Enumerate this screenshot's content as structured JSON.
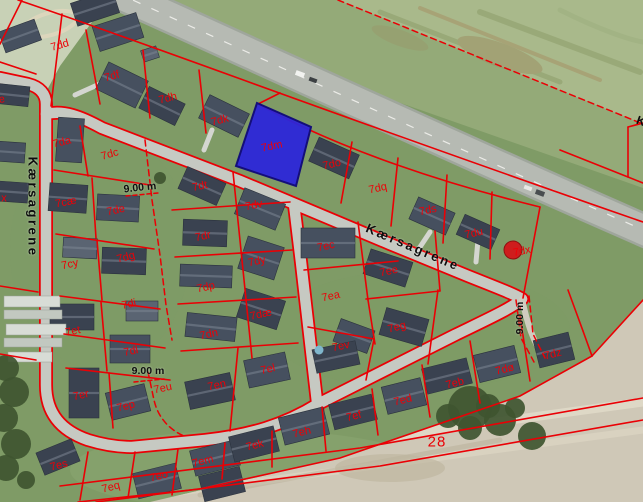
{
  "map": {
    "selected_parcel": {
      "label": "7dm",
      "fill_color": "#2c26d9",
      "border_color": "#140e7a"
    },
    "marker": {
      "type": "circle",
      "color": "#ce1d1d",
      "on_parcel": "7dx"
    },
    "colors": {
      "cadastral_line": "#ea0005",
      "parcel_label": "#ed0007",
      "street_label": "#0d0d0d",
      "highway": "#b6bab3",
      "grass": "#7f9b66",
      "field_dirt": "#cfc8b7"
    },
    "street_labels": [
      {
        "text": "Kærsagrene",
        "x": 33,
        "y": 207,
        "rot": 90
      },
      {
        "text": "Kærsagrene",
        "x": 413,
        "y": 247,
        "rot": 23
      }
    ],
    "measurement_labels": [
      {
        "text": "9.00 m",
        "x": 140,
        "y": 188,
        "rot": -6
      },
      {
        "text": "9.00 m",
        "x": 148,
        "y": 371,
        "rot": 0
      },
      {
        "text": "9.00 m",
        "x": 520,
        "y": 318,
        "rot": -90
      }
    ],
    "area_labels": [
      {
        "text": "28",
        "x": 437,
        "y": 442,
        "rot": 0
      }
    ],
    "partial_labels": [
      {
        "text": "x",
        "x": 4,
        "y": 199,
        "rot": 0,
        "color": "red"
      },
      {
        "text": "e",
        "x": 2,
        "y": 100,
        "rot": -12,
        "color": "red"
      },
      {
        "text": "K",
        "x": 641,
        "y": 121,
        "rot": 20,
        "color": "black"
      }
    ],
    "parcel_labels": [
      {
        "text": "7dd",
        "x": 60,
        "y": 46,
        "rot": -16
      },
      {
        "text": "7df",
        "x": 112,
        "y": 77,
        "rot": -16
      },
      {
        "text": "7dh",
        "x": 168,
        "y": 99,
        "rot": -14
      },
      {
        "text": "7dk",
        "x": 220,
        "y": 121,
        "rot": -14
      },
      {
        "text": "7dm",
        "x": 272,
        "y": 147,
        "rot": -12
      },
      {
        "text": "7do",
        "x": 332,
        "y": 165,
        "rot": -12
      },
      {
        "text": "7dq",
        "x": 378,
        "y": 189,
        "rot": -12
      },
      {
        "text": "7ds",
        "x": 428,
        "y": 211,
        "rot": -12
      },
      {
        "text": "7du",
        "x": 474,
        "y": 234,
        "rot": -12
      },
      {
        "text": "7dx",
        "x": 522,
        "y": 252,
        "rot": -12
      },
      {
        "text": "7da",
        "x": 62,
        "y": 143,
        "rot": -14
      },
      {
        "text": "7dc",
        "x": 110,
        "y": 155,
        "rot": -16
      },
      {
        "text": "7cæ",
        "x": 66,
        "y": 203,
        "rot": -10
      },
      {
        "text": "7de",
        "x": 116,
        "y": 211,
        "rot": -12
      },
      {
        "text": "7dg",
        "x": 126,
        "y": 258,
        "rot": -14
      },
      {
        "text": "7cy",
        "x": 70,
        "y": 265,
        "rot": -12
      },
      {
        "text": "7dt",
        "x": 200,
        "y": 187,
        "rot": -12
      },
      {
        "text": "7dv",
        "x": 254,
        "y": 206,
        "rot": -12
      },
      {
        "text": "7dr",
        "x": 203,
        "y": 237,
        "rot": -12
      },
      {
        "text": "7dy",
        "x": 257,
        "y": 262,
        "rot": -12
      },
      {
        "text": "7dp",
        "x": 206,
        "y": 288,
        "rot": -12
      },
      {
        "text": "7dæ",
        "x": 261,
        "y": 315,
        "rot": -12
      },
      {
        "text": "7dn",
        "x": 209,
        "y": 335,
        "rot": -12
      },
      {
        "text": "7ec",
        "x": 326,
        "y": 247,
        "rot": -12
      },
      {
        "text": "7ea",
        "x": 331,
        "y": 297,
        "rot": -12
      },
      {
        "text": "7ee",
        "x": 389,
        "y": 272,
        "rot": -12
      },
      {
        "text": "7eg",
        "x": 397,
        "y": 328,
        "rot": -14
      },
      {
        "text": "7di",
        "x": 129,
        "y": 305,
        "rot": -12
      },
      {
        "text": "7dl",
        "x": 131,
        "y": 352,
        "rot": -12
      },
      {
        "text": "7et",
        "x": 73,
        "y": 332,
        "rot": -12
      },
      {
        "text": "7er",
        "x": 81,
        "y": 396,
        "rot": -12
      },
      {
        "text": "7ep",
        "x": 126,
        "y": 407,
        "rot": -14
      },
      {
        "text": "7eu",
        "x": 163,
        "y": 389,
        "rot": -12
      },
      {
        "text": "7es",
        "x": 59,
        "y": 466,
        "rot": -14
      },
      {
        "text": "7eq",
        "x": 111,
        "y": 488,
        "rot": -14
      },
      {
        "text": "7eo",
        "x": 159,
        "y": 477,
        "rot": -14
      },
      {
        "text": "7em",
        "x": 203,
        "y": 462,
        "rot": -14
      },
      {
        "text": "7ek",
        "x": 255,
        "y": 446,
        "rot": -14
      },
      {
        "text": "7eh",
        "x": 302,
        "y": 433,
        "rot": -14
      },
      {
        "text": "7ef",
        "x": 354,
        "y": 417,
        "rot": -14
      },
      {
        "text": "7ed",
        "x": 403,
        "y": 401,
        "rot": -14
      },
      {
        "text": "7eb",
        "x": 455,
        "y": 384,
        "rot": -14
      },
      {
        "text": "7dø",
        "x": 505,
        "y": 370,
        "rot": -14
      },
      {
        "text": "7dz",
        "x": 553,
        "y": 355,
        "rot": -14
      },
      {
        "text": "7en",
        "x": 217,
        "y": 386,
        "rot": -12
      },
      {
        "text": "7el",
        "x": 268,
        "y": 370,
        "rot": -12
      },
      {
        "text": "7ev",
        "x": 341,
        "y": 347,
        "rot": -12
      }
    ]
  }
}
